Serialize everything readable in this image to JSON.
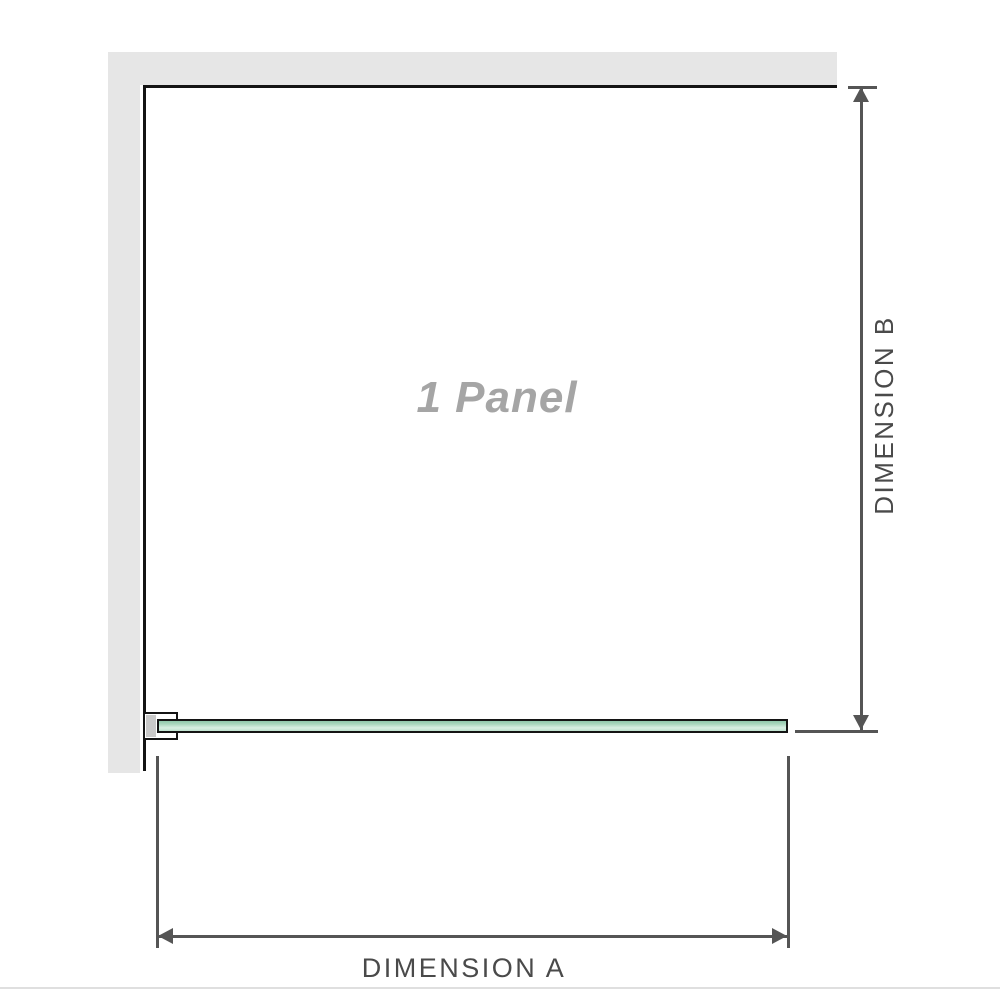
{
  "diagram": {
    "panel_label": "1 Panel",
    "dimension_a": {
      "label": "DIMENSION A"
    },
    "dimension_b": {
      "label": "DIMENSION B"
    }
  },
  "colors": {
    "wall": "#e6e6e6",
    "outline": "#141414",
    "dimension": "#555555",
    "dimension_text": "#4a4a4a",
    "panel_text": "#a5a5a5",
    "glass_top": "#8fc8ab",
    "glass_light": "#d8efe2",
    "glass_bottom": "#bfe2cf",
    "bracket_shim": "#c9c9c9",
    "divider": "#dfdfdf"
  }
}
